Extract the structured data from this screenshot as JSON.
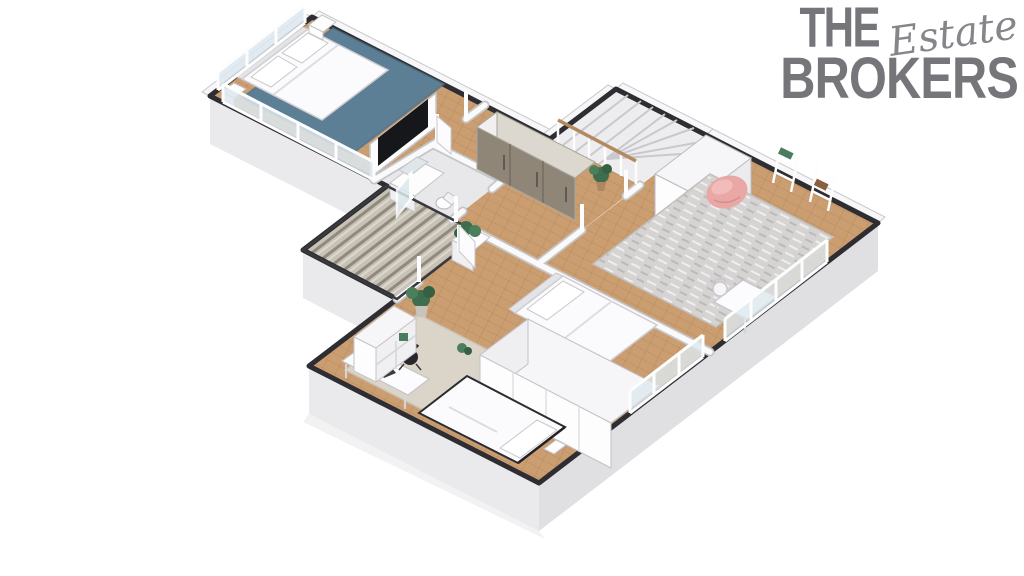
{
  "logo": {
    "word_top": "THE",
    "word_script": "Estate",
    "word_bottom": "BROKERS"
  },
  "colors": {
    "logo_gray": "#76767a",
    "wall_dark": "#2e2e32",
    "slab_light": "#eaeaec",
    "slab_mid": "#e0e0e2",
    "wood": "#cb9e72",
    "rug_blue": "#5d7f96",
    "rug_gray": "#d6d4d2",
    "rug_beige": "#dbd5c9",
    "wardrobe_brown": "#8f8678",
    "furniture_white": "#fbfbfd",
    "tv_black": "#15171a",
    "chair_black": "#28282b",
    "beanbag_pink": "#e9a8a6",
    "plant_green": "#3e6e4e",
    "handrail_wood": "#b18b5e",
    "stair_gray": "#ededef",
    "deck_light": "#c8c2b6",
    "deck_dark": "#8f897e",
    "glass_blue": "#dce8ee"
  },
  "scene": {
    "type": "isometric-3d-floor-plan-render",
    "rooms": [
      {
        "name": "bedroom-top-left",
        "items": [
          "double-bed",
          "pillows",
          "nightstands",
          "blue-rug",
          "tv-partition",
          "window-wall"
        ]
      },
      {
        "name": "hallway",
        "items": [
          "brown-wardrobe",
          "plant",
          "door-frames",
          "wood-floor"
        ]
      },
      {
        "name": "bathroom",
        "items": [
          "sink-vanity",
          "mirror",
          "toilet"
        ]
      },
      {
        "name": "staircase",
        "items": [
          "winder-stairs",
          "white-balusters",
          "wood-handrail",
          "tall-white-closet"
        ]
      },
      {
        "name": "balcony",
        "items": [
          "striped-wood-deck",
          "white-planter",
          "open-glass-door"
        ]
      },
      {
        "name": "room-right",
        "items": [
          "pink-bean-bag",
          "gray-rug",
          "ladder-shelves",
          "white-desk",
          "white-chair",
          "windows"
        ]
      },
      {
        "name": "bedroom-bottom",
        "items": [
          "double-bed",
          "single-bed",
          "long-white-wardrobe",
          "desk",
          "black-office-chair",
          "white-shelf",
          "monstera-plant",
          "beige-rug",
          "windows"
        ]
      }
    ]
  }
}
